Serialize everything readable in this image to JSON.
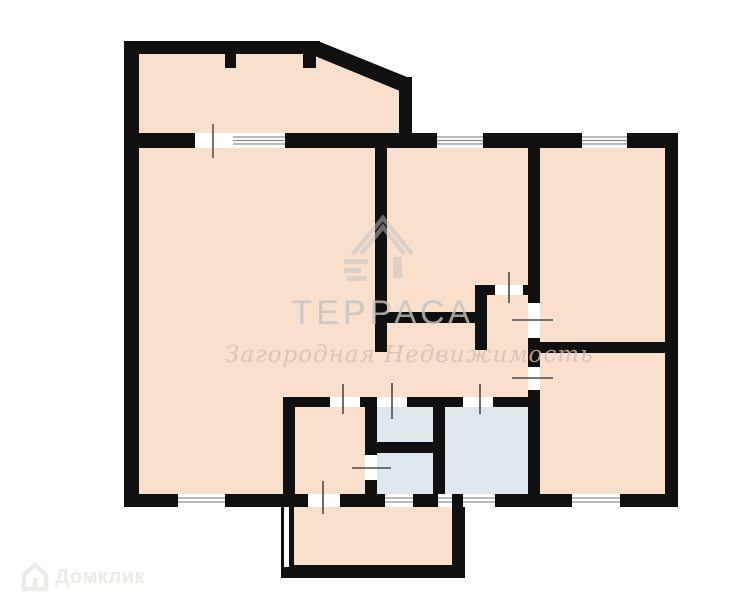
{
  "watermarks": {
    "brand_title": "ТЕРРАСА",
    "brand_subtitle": "Загородная Недвижимость",
    "platform_name": "Домклик"
  },
  "colors": {
    "room_fill": "#f8e0cd",
    "wet_room_fill": "#dfe9ed",
    "wall": "#101010",
    "window_line": "#8f8f8f",
    "tick": "#4a4a4a",
    "balcony_tick": "#6b4c3c",
    "brand_watermark": "#c6c2bf",
    "brand_script": "#d8bcb0",
    "platform_logo": "#edebe8"
  }
}
